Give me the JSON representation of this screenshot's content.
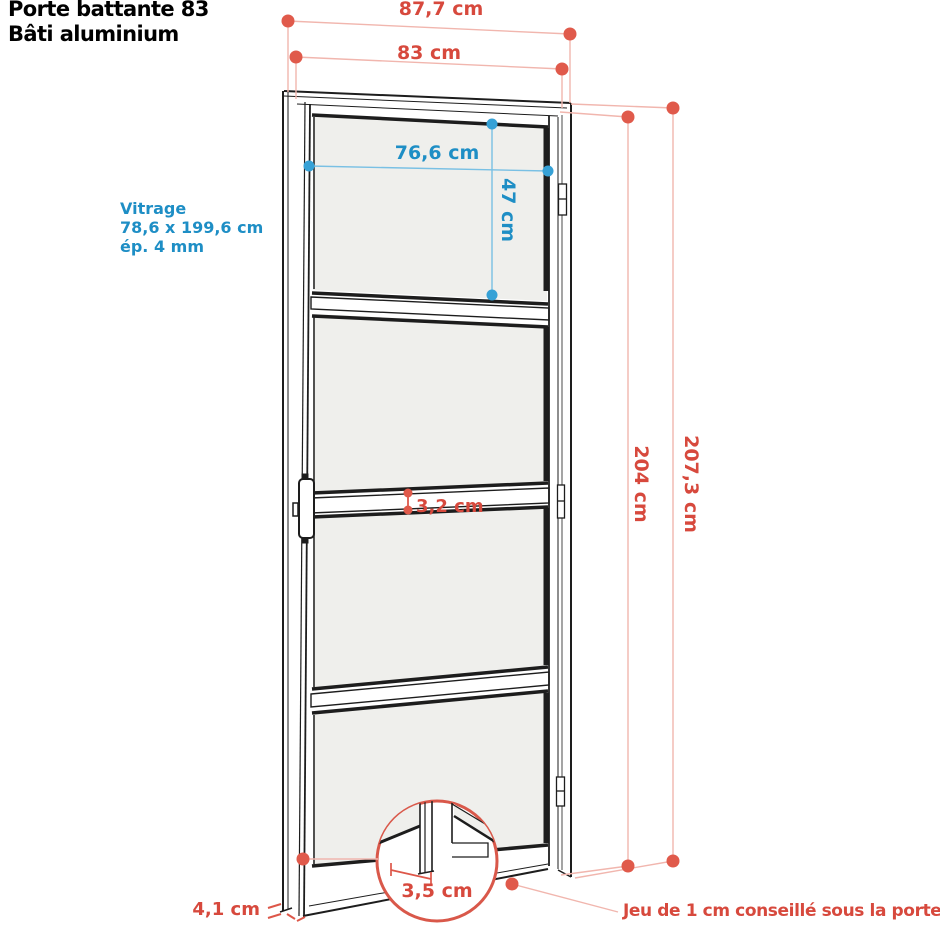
{
  "title": {
    "line1": "Porte battante 83",
    "line2": "Bâti aluminium"
  },
  "glazing_label": {
    "line1": "Vitrage",
    "line2": "78,6 x 199,6 cm",
    "line3": "ép. 4 mm"
  },
  "dimensions": {
    "outer_width": "87,7 cm",
    "inner_width": "83 cm",
    "glass_width": "76,6 cm",
    "top_panel_height": "47 cm",
    "inner_height": "204 cm",
    "outer_height": "207,3 cm",
    "crossbar_thickness": "3,2 cm",
    "bottom_rail_depth": "3,5 cm",
    "frame_depth": "4,1 cm"
  },
  "note": "Jeu de 1 cm conseillé sous la porte",
  "colors": {
    "dimension_red_text": "#d7493d",
    "dimension_red_dot": "#e05a4b",
    "dimension_red_line": "#f1b6ae",
    "dimension_blue_text": "#1e8ec5",
    "dimension_blue_dot": "#36a1d6",
    "dimension_blue_line": "#79c0e4",
    "glass_fill": "#efefec",
    "outline": "#1d1d1d",
    "background": "#ffffff"
  }
}
